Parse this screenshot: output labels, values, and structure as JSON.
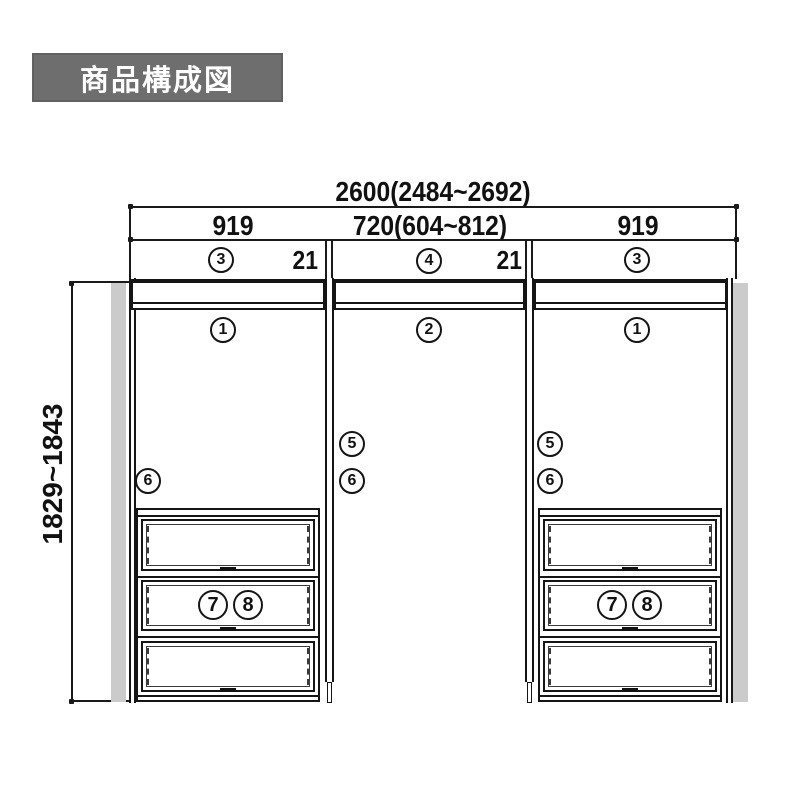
{
  "title": "商品構成図",
  "dimensions": {
    "total_width": "2600(2484~2692)",
    "left_section_width": "919",
    "center_section_width": "720(604~812)",
    "right_section_width": "919",
    "panel_gap_left": "21",
    "panel_gap_right": "21",
    "height_range": "1829~1843"
  },
  "part_markers": {
    "p1": "1",
    "p2": "2",
    "p3": "3",
    "p4": "4",
    "p5": "5",
    "p6": "6",
    "p7": "7",
    "p8": "8"
  }
}
